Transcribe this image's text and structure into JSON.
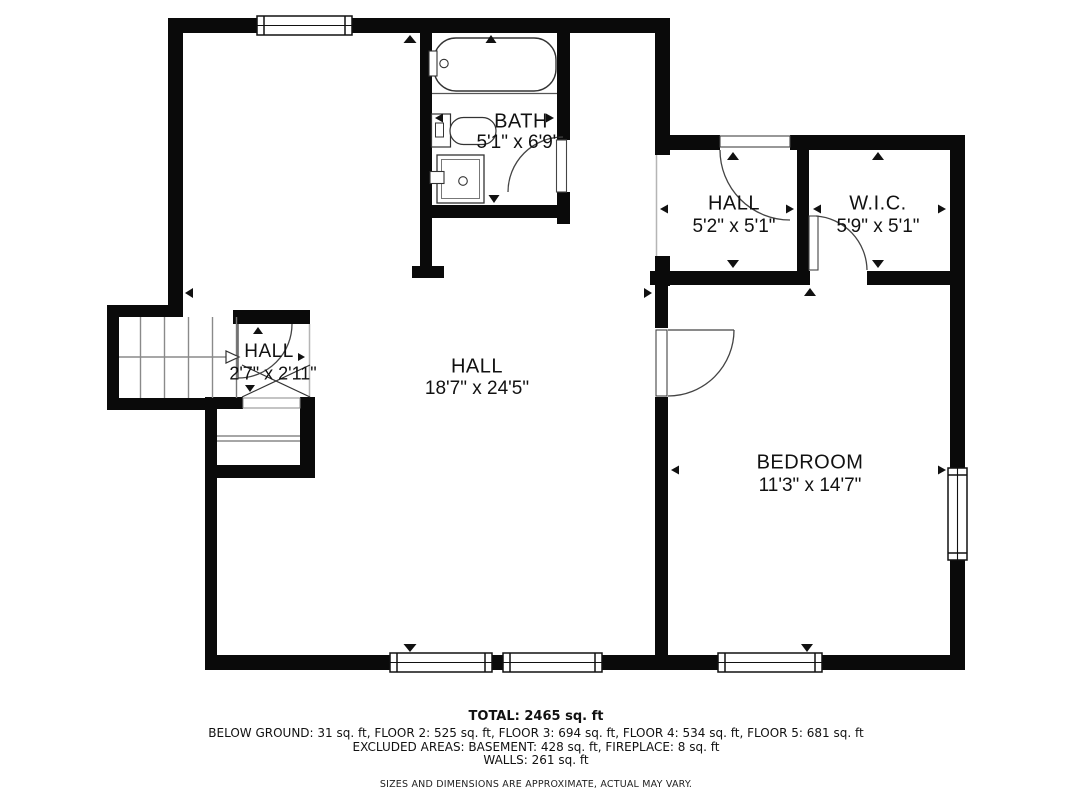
{
  "floorplan": {
    "title": "floor plan",
    "rooms": [
      {
        "id": "bath",
        "name": "BATH",
        "dims": "5'1\" x 6'9\""
      },
      {
        "id": "hall-upper",
        "name": "HALL",
        "dims": "5'2\" x 5'1\""
      },
      {
        "id": "wic",
        "name": "W.I.C.",
        "dims": "5'9\" x 5'1\""
      },
      {
        "id": "hall-stairs",
        "name": "HALL",
        "dims": "2'7\" x 2'11\""
      },
      {
        "id": "hall-main",
        "name": "HALL",
        "dims": "18'7\" x 24'5\""
      },
      {
        "id": "bedroom",
        "name": "BEDROOM",
        "dims": "11'3\" x 14'7\""
      }
    ],
    "colors": {
      "wall": "#0a0a0a",
      "background": "#ffffff",
      "thin_line": "#8a8a8a"
    }
  },
  "footer": {
    "total": "TOTAL: 2465 sq. ft",
    "floors": "BELOW GROUND: 31 sq. ft, FLOOR 2: 525 sq. ft, FLOOR 3: 694 sq. ft, FLOOR 4: 534 sq. ft, FLOOR 5: 681 sq. ft",
    "excluded": "EXCLUDED AREAS: BASEMENT: 428 sq. ft, FIREPLACE: 8 sq. ft",
    "walls": "WALLS: 261 sq. ft",
    "disclaimer": "SIZES AND DIMENSIONS ARE APPROXIMATE, ACTUAL MAY VARY."
  }
}
